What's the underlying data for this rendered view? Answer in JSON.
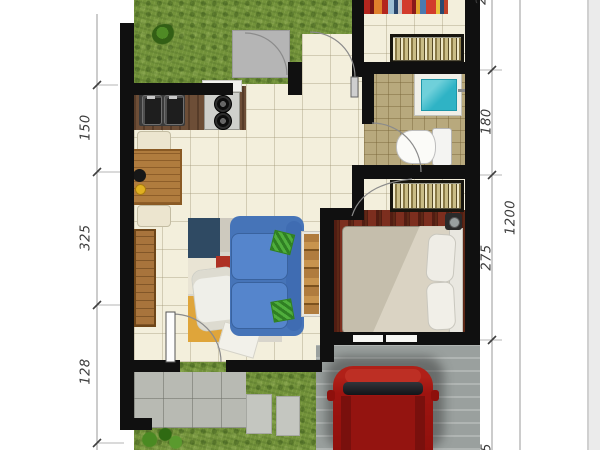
{
  "plan": {
    "type": "house floor plan, top view",
    "dimension_labels": {
      "left_side": [
        {
          "value": "150"
        },
        {
          "value": "325"
        },
        {
          "value": "128"
        }
      ],
      "right_side": [
        {
          "value": "2"
        },
        {
          "value": "180"
        },
        {
          "value": "275"
        },
        {
          "value": "5"
        }
      ],
      "right_overall": {
        "value": "1200"
      }
    },
    "elements": {
      "garden": [
        "grass lawn",
        "shrub",
        "door mat",
        "back door"
      ],
      "kitchen": [
        "double sink",
        "two-burner stove",
        "counter",
        "dining table",
        "two chairs",
        "tableware"
      ],
      "living_room": [
        "two-seat sofa",
        "green cushions",
        "patchwork rug",
        "white armchair",
        "ladder shelf",
        "sideboard",
        "front door"
      ],
      "bathroom": [
        "water basin",
        "toilet",
        "tiled floor",
        "door"
      ],
      "bedroom": [
        "double bed",
        "pillows",
        "wardrobe",
        "maroon rug",
        "window",
        "bedside object"
      ],
      "utility_area": [
        "wardrobe rack",
        "striped rug"
      ],
      "exterior": [
        "terrace tiles",
        "stepping stones",
        "lawn",
        "plant",
        "carport",
        "red car"
      ]
    },
    "colors": {
      "wall": "#101010",
      "floor_tile": "#f3efdc",
      "grass": "#72923a",
      "bath_floor": "#b8a97d",
      "sofa_blue": "#4d7ec6",
      "car_red": "#a31511",
      "basin_water": "#2fb3c5",
      "terrace_gray": "#b8bab3",
      "carport_gray": "#9aa09e",
      "wood_brown": "#b07c3e",
      "bed_rug_maroon": "#7c2e1e"
    }
  }
}
